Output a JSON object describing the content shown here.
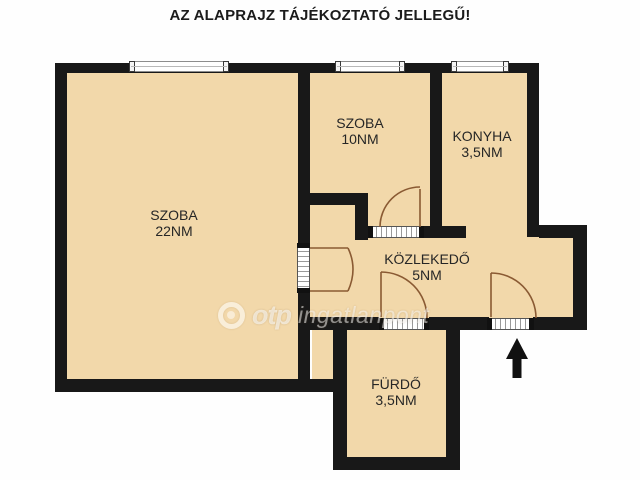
{
  "title": "AZ ALAPRAJZ TÁJÉKOZTATÓ JELLEGŰ!",
  "rooms": [
    {
      "name": "SZOBA",
      "area": "22NM"
    },
    {
      "name": "SZOBA",
      "area": "10NM"
    },
    {
      "name": "KONYHA",
      "area": "3,5NM"
    },
    {
      "name": "KÖZLEKEDŐ",
      "area": "5NM"
    },
    {
      "name": "FÜRDŐ",
      "area": "3,5NM"
    }
  ],
  "watermark": {
    "brand": "otp",
    "text": "ingatlanpont",
    "logo_icon": "otp-circle-logo"
  },
  "entrance": {
    "icon": "up-arrow"
  },
  "colors": {
    "floor": "#f2d8aa",
    "wall": "#181818",
    "door_swing": "#8a5a33",
    "background": "#fefefe",
    "watermark": "rgba(255,255,255,0.6)"
  }
}
